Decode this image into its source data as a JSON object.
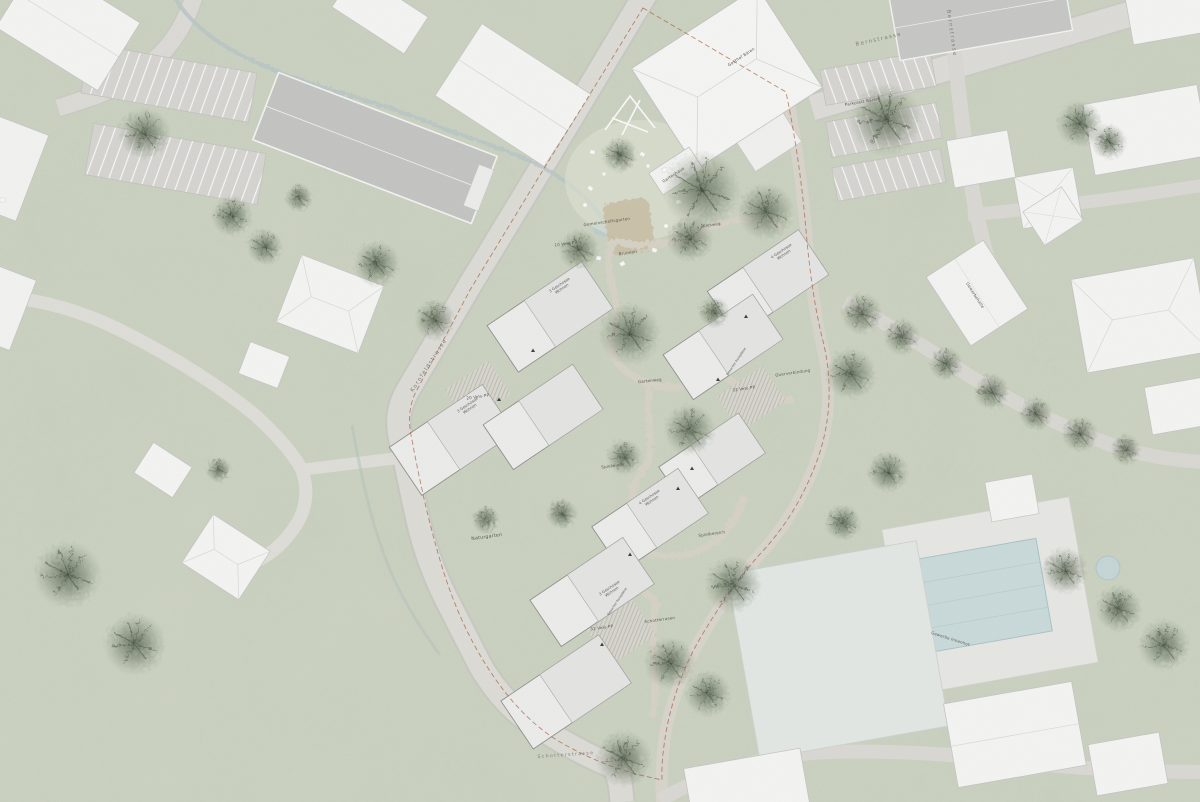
{
  "plan": {
    "type": "architectural site plan",
    "labels": {
      "bernstrasse": "Bernstrasse",
      "gasthof_baeren": "Gasthof Bären",
      "parkplatz_baeren": "Parkplatz Bären",
      "gartenhaus": "Gartenhaus",
      "gemeinschaftsgarten": "Gemeinschaftsgarten",
      "brunnen": "Brunnen",
      "velo_pp_10": "10 Velo PP",
      "velo_pp_20": "20 Velo PP",
      "velo_pp_32": "32 Velo PP",
      "kiesweg": "Kiesweg",
      "gartenweg": "Gartenweg",
      "spielwiese": "Spielwiese",
      "spielbereich": "Spielbereich",
      "schotterrasen": "Schotterrasen",
      "querverbindung": "Querverbindung",
      "besucher_pp": "Besucher Parkplätze",
      "naturgarten": "Naturgarten",
      "kornfeldstrasse": "Kornfeldstrasse",
      "schotterstrasse": "Schotterstrasse",
      "gewerbehalle": "Gewerbehalle",
      "gewerbe_innenhof": "Gewerbe Innenhof",
      "building_3g": {
        "line1": "3 Geschosse",
        "line2": "Wohnen"
      },
      "building_4g": {
        "line1": "4 Geschosse",
        "line2": "Wohnen"
      }
    },
    "colors": {
      "grass": "#ccd2c1",
      "road": "#dcdbd6",
      "gravel_path": "#d8d3c5",
      "building_existing": "#f4f4f3",
      "building_new": "#ececea",
      "roof_gray": "#c3c4c2",
      "tree": "#5c6a55",
      "water": "#b9c6c6",
      "pool": "#c9dada",
      "boundary_dashed": "#a0522d"
    }
  }
}
